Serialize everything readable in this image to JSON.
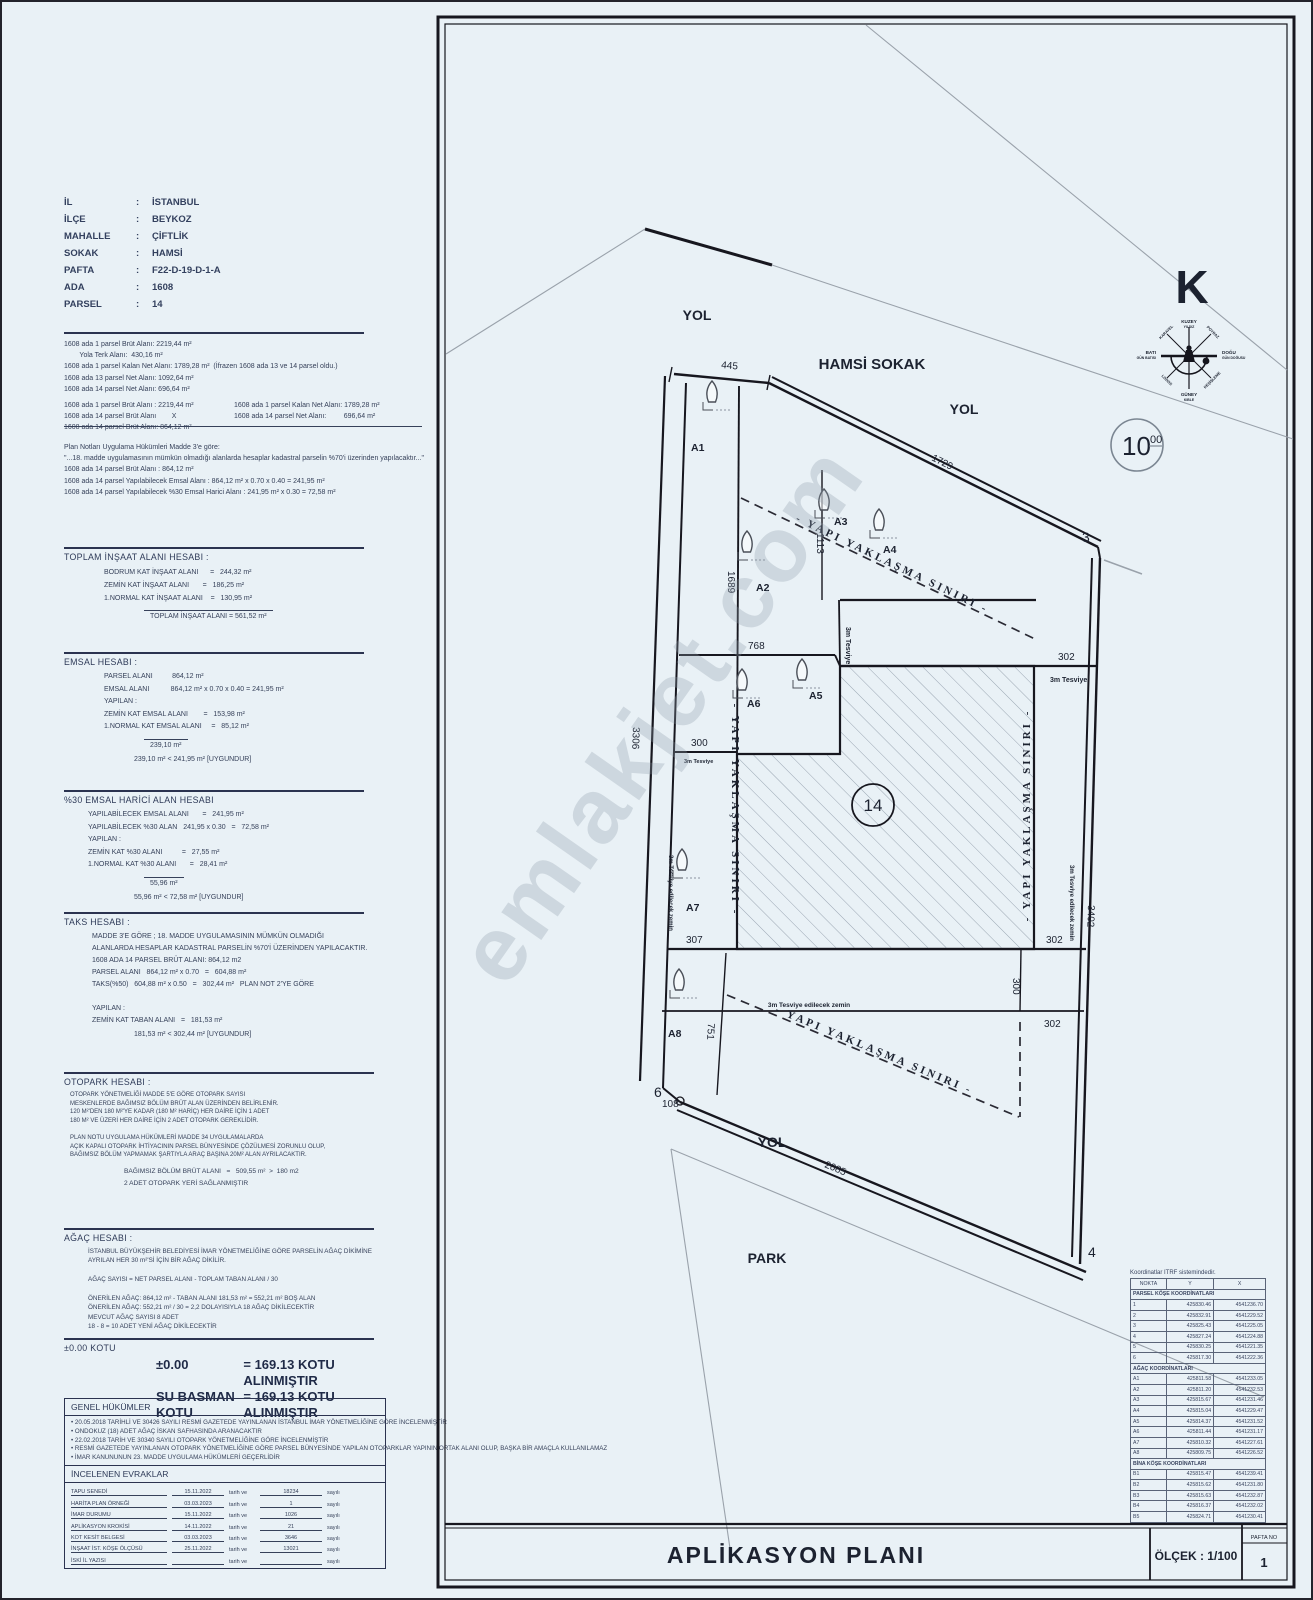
{
  "watermark": "emlakjet.com",
  "info": {
    "rows": [
      {
        "label": "İL",
        "value": "İSTANBUL"
      },
      {
        "label": "İLÇE",
        "value": "BEYKOZ"
      },
      {
        "label": "MAHALLE",
        "value": "ÇİFTLİK"
      },
      {
        "label": "SOKAK",
        "value": "HAMSİ"
      },
      {
        "label": "PAFTA",
        "value": "F22-D-19-D-1-A"
      },
      {
        "label": "ADA",
        "value": "1608"
      },
      {
        "label": "PARSEL",
        "value": "14"
      }
    ]
  },
  "area_notes": {
    "block1": [
      "1608 ada 1 parsel Brüt Alanı: 2219,44 m²",
      "        Yola Terk Alanı:  430,16 m²",
      "1608 ada 1 parsel Kalan Net Alanı: 1789,28 m²  (İfrazen 1608 ada 13 ve 14 parsel oldu.)",
      "1608 ada 13 parsel Net Alanı: 1092,64 m²",
      "1608 ada 14 parsel Net Alanı: 696,64 m²"
    ],
    "block2_left": [
      "1608 ada 1 parsel Brüt Alanı : 2219,44 m²",
      "1608 ada 14 parsel Brüt Alanı        X",
      "1608 ada 14 parsel Brüt Alanı: 864,12 m²"
    ],
    "block2_right": [
      "1608 ada 1 parsel Kalan Net Alanı: 1789,28 m²",
      "1608 ada 14 parsel Net Alanı:         696,64 m²"
    ],
    "block3": [
      "Plan Notları Uygulama Hükümleri Madde 3'e göre:",
      "\"...18. madde uygulamasının mümkün olmadığı alanlarda hesaplar kadastral parselin %70'i üzerinden yapılacaktır...\"",
      "1608 ada 14 parsel Brüt Alanı : 864,12 m²",
      "1608 ada 14 parsel Yapılabilecek Emsal Alanı : 864,12 m² x 0.70 x 0.40 = 241,95 m²",
      "1608 ada 14 parsel Yapılabilecek %30 Emsal Harici Alanı : 241,95 m² x 0.30 = 72,58 m²"
    ]
  },
  "sections": {
    "toplam": {
      "title": "TOPLAM İNŞAAT ALANI HESABI :",
      "lines": [
        "BODRUM KAT İNŞAAT ALANI      =   244,32 m²",
        "ZEMİN KAT İNŞAAT ALANI       =   186,25 m²",
        "1.NORMAL KAT İNŞAAT ALANI    =   130,95 m²"
      ],
      "total": "TOPLAM İNŞAAT ALANI   =   561,52 m²"
    },
    "emsal": {
      "title": "EMSAL HESABI :",
      "lines": [
        "PARSEL ALANI          864,12 m²",
        "EMSAL ALANI           864,12 m² x 0.70 x 0.40 = 241,95 m²",
        "YAPILAN :",
        "ZEMİN KAT EMSAL ALANI        =   153,98 m²",
        "1.NORMAL KAT EMSAL ALANI     =   85,12 m²"
      ],
      "total": "239,10 m²",
      "compare": "239,10 m²   <   241,95 m²   [UYGUNDUR]"
    },
    "emsal30": {
      "title": "%30 EMSAL HARİCİ ALAN HESABI",
      "lines": [
        "YAPILABİLECEK EMSAL ALANI       =   241,95 m²",
        "YAPILABİLECEK %30 ALAN   241,95 x 0.30   =   72,58 m²",
        "YAPILAN :",
        "ZEMİN KAT %30 ALANI          =   27,55 m²",
        "1.NORMAL KAT %30 ALANI       =   28,41 m²"
      ],
      "total": "55,96 m²",
      "compare": "55,96 m²   <   72,58 m²   [UYGUNDUR]"
    },
    "taks": {
      "title": "TAKS HESABI :",
      "lines": [
        "MADDE 3'E GÖRE ; 18. MADDE UYGULAMASININ MÜMKÜN OLMADIĞI",
        "ALANLARDA HESAPLAR KADASTRAL PARSELİN %70'İ ÜZERİNDEN YAPILACAKTIR.",
        "1608 ADA 14 PARSEL BRÜT ALANI: 864,12 m2",
        "PARSEL ALANI   864,12 m² x 0.70   =   604,88 m²",
        "TAKS(%50)   604,88 m² x 0.50   =   302,44 m²   PLAN NOT 2'YE GÖRE",
        "",
        "YAPILAN :",
        "ZEMİN KAT TABAN ALANI   =   181,53 m²"
      ],
      "compare": "181,53 m²   <   302,44 m²   [UYGUNDUR]"
    },
    "otopark": {
      "title": "OTOPARK HESABI :",
      "small_lines": [
        "OTOPARK YÖNETMELİĞİ MADDE 5'E GÖRE OTOPARK SAYISI",
        "MESKENLERDE BAĞIMSIZ BÖLÜM BRÜT ALAN ÜZERİNDEN BELİRLENİR.",
        "120 M²'DEN 180 M²'YE KADAR (180 M² HARİÇ) HER DAİRE İÇİN 1 ADET",
        "180 M² VE ÜZERİ HER DAİRE İÇİN 2 ADET OTOPARK GEREKLİDİR.",
        "",
        "PLAN NOTU UYGULAMA HÜKÜMLERİ MADDE 34 UYGULAMALARDA",
        "AÇIK KAPALI OTOPARK İHTİYACININ PARSEL BÜNYESİNDE ÇÖZÜLMESİ ZORUNLU OLUP,",
        "BAĞIMSIZ BÖLÜM YAPMAMAK ŞARTIYLA ARAÇ BAŞINA 20M² ALAN AYRILACAKTIR."
      ],
      "result_lines": [
        "BAĞIMSIZ BÖLÜM BRÜT ALANI   =   509,55 m²  >  180 m2",
        "2 ADET OTOPARK YERİ SAĞLANMIŞTIR"
      ]
    },
    "agac": {
      "title": "AĞAÇ HESABI :",
      "lines": [
        "İSTANBUL BÜYÜKŞEHİR BELEDİYESİ İMAR YÖNETMELİĞİNE GÖRE PARSELİN AĞAÇ DİKİMİNE",
        "AYRILAN HER 30 m²'Sİ İÇİN BİR AĞAÇ DİKİLİR.",
        "",
        "AĞAÇ SAYISI = NET PARSEL ALANI - TOPLAM TABAN ALANI / 30",
        "",
        "ÖNERİLEN AĞAÇ: 864,12 m² - TABAN ALANI 181,53 m² = 552,21 m² BOŞ ALAN",
        "ÖNERİLEN AĞAÇ: 552,21 m² / 30 = 2,2 DOLAYISIYLA 18 AĞAÇ DİKİLECEKTİR",
        "MEVCUT AĞAÇ SAYISI 8 ADET",
        "18 - 8 = 10 ADET YENİ AĞAÇ DİKİLECEKTİR"
      ]
    },
    "kot": {
      "title": "±0.00 KOTU",
      "rows": [
        [
          "±0.00",
          "= 169.13 KOTU ALINMIŞTIR"
        ],
        [
          "SU BASMAN KOTU",
          "= 169.13 KOTU ALINMIŞTIR"
        ]
      ]
    }
  },
  "genel": {
    "title": "GENEL HÜKÜMLER",
    "bullets": [
      "20.05.2018 TARİHLİ VE 30426 SAYILI RESMİ GAZETEDE YAYINLANAN İSTANBUL İMAR YÖNETMELİĞİNE GÖRE İNCELENMİŞTİR",
      "ONDOKUZ (18) ADET AĞAÇ İSKAN SAFHASINDA ARANACAKTIR",
      "22.02.2018 TARİH VE 30340 SAYILI OTOPARK YÖNETMELİĞİNE GÖRE İNCELENMİŞTİR",
      "RESMİ GAZETEDE YAYINLANAN OTOPARK YÖNETMELİĞİNE GÖRE PARSEL BÜNYESİNDE YAPILAN OTOPARKLAR YAPININ ORTAK ALANI OLUP, BAŞKA BİR AMAÇLA KULLANILAMAZ",
      "İMAR KANUNUNUN 23. MADDE UYGULAMA HÜKÜMLERİ GEÇERLİDİR"
    ]
  },
  "evraklar": {
    "title": "İNCELENEN EVRAKLAR",
    "rows": [
      [
        "TAPU SENEDİ",
        "15.11.2022",
        "tarih ve",
        "18234",
        "sayılı"
      ],
      [
        "HARİTA PLAN ÖRNEĞİ",
        "03.03.2023",
        "tarih ve",
        "1",
        "sayılı"
      ],
      [
        "İMAR DURUMU",
        "15.11.2022",
        "tarih ve",
        "1026",
        "sayılı"
      ],
      [
        "APLİKASYON KROKİSİ",
        "14.11.2022",
        "tarih ve",
        "21",
        "sayılı"
      ],
      [
        "KOT KESİT BELGESİ",
        "03.03.2023",
        "tarih ve",
        "3646",
        "sayılı"
      ],
      [
        "İNŞAAT İST. KÖŞE ÖLÇÜSÜ",
        "25.11.2022",
        "tarih ve",
        "13021",
        "sayılı"
      ],
      [
        "İSKİ İL YAZISI",
        "",
        "tarih ve",
        "",
        "sayılı"
      ]
    ]
  },
  "plan": {
    "labels": {
      "yol1": "YOL",
      "hamsi": "HAMSİ SOKAK",
      "yol2": "YOL",
      "yol3": "YOL",
      "park": "PARK",
      "parcel_no": "14",
      "road_width_big": "10",
      "road_width_sup": "00"
    },
    "dims": {
      "d445": "445",
      "d1729": "1729",
      "d3306": "3306",
      "d1689": "1689",
      "d1113": "1113",
      "d768": "768",
      "d302_top": "302",
      "d300_terrace": "300",
      "d307": "307",
      "d302_mid": "302",
      "d302_low": "302",
      "d300_right": "300",
      "d751": "751",
      "d2085": "2085",
      "d3402": "3402",
      "p3": "3",
      "p4": "4",
      "p6": "6",
      "p108": "108"
    },
    "notes": {
      "setback": "- YAPI YAKLAŞMA SINIRI -",
      "tesviye": "3m Tesviye",
      "tesviye_zemin": "3m Tesviye edilecek zemin"
    },
    "compass": {
      "k": "K",
      "n": "KUZEY",
      "n2": "YILDIZ",
      "w": "BATI",
      "w2": "GÜN BATISI",
      "e": "DOĞU",
      "e2": "GÜN DOĞUSU",
      "s": "GÜNEY",
      "s2": "KIBLE",
      "nw": "KARAYEL",
      "ne": "POYRAZ",
      "sw": "LODOS",
      "se": "KEŞİŞLEME"
    },
    "trees": [
      {
        "label": "A1"
      },
      {
        "label": "A2"
      },
      {
        "label": "A3"
      },
      {
        "label": "A4"
      },
      {
        "label": "A5"
      },
      {
        "label": "A6"
      },
      {
        "label": "A7"
      },
      {
        "label": "A8"
      }
    ]
  },
  "coords_table": {
    "title": "Koordinatlar ITRF sistemindedir.",
    "headers": [
      "NOKTA",
      "Y",
      "X"
    ],
    "sections": [
      {
        "header": "PARSEL KÖŞE KOORDİNATLARI",
        "rows": [
          [
            "1",
            "425830.46",
            "4541236.70"
          ],
          [
            "2",
            "425832.91",
            "4541229.52"
          ],
          [
            "3",
            "425825.43",
            "4541225.05"
          ],
          [
            "4",
            "425827.24",
            "4541224.88"
          ],
          [
            "5",
            "425830.25",
            "4541221.35"
          ],
          [
            "6",
            "425817.30",
            "4541222.36"
          ]
        ]
      },
      {
        "header": "AĞAÇ KOORDİNATLARI",
        "rows": [
          [
            "A1",
            "425811.58",
            "4541233.05"
          ],
          [
            "A2",
            "425811.20",
            "4541232.53"
          ],
          [
            "A3",
            "425815.67",
            "4541231.46"
          ],
          [
            "A4",
            "425815.04",
            "4541229.47"
          ],
          [
            "A5",
            "425814.37",
            "4541231.52"
          ],
          [
            "A6",
            "425811.44",
            "4541231.17"
          ],
          [
            "A7",
            "425810.32",
            "4541227.61"
          ],
          [
            "A8",
            "425809.75",
            "4541226.52"
          ]
        ]
      },
      {
        "header": "BİNA KÖŞE KOORDİNATLARI",
        "rows": [
          [
            "B1",
            "425815.47",
            "4541239.41"
          ],
          [
            "B2",
            "425815.62",
            "4541231.80"
          ],
          [
            "B3",
            "425815.63",
            "4541232.87"
          ],
          [
            "B4",
            "425816.37",
            "4541232.02"
          ],
          [
            "B5",
            "425824.71",
            "4541230.41"
          ]
        ]
      }
    ]
  },
  "titleblock": {
    "title": "APLİKASYON  PLANI",
    "scale_text": "ÖLÇEK :  1/100",
    "pafta_label": "PAFTA NO",
    "pafta_value": "1"
  }
}
